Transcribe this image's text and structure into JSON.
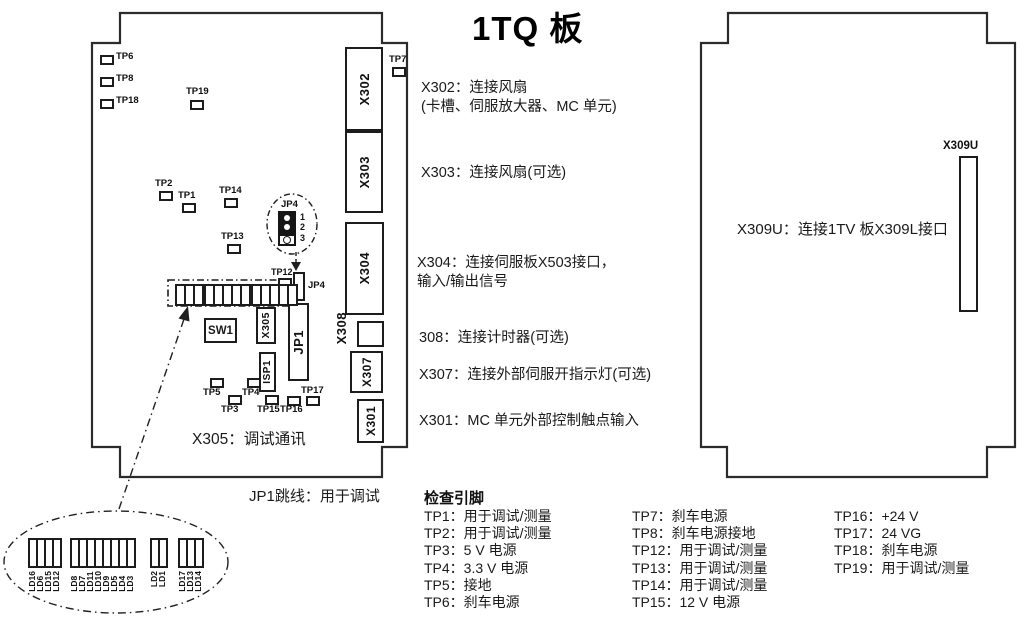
{
  "title": "1TQ 板",
  "boards": {
    "left": {
      "test_points": {
        "tp6": "TP6",
        "tp8": "TP8",
        "tp18": "TP18",
        "tp19": "TP19",
        "tp2": "TP2",
        "tp1": "TP1",
        "tp14": "TP14",
        "tp13": "TP13",
        "tp12": "TP12",
        "tp7": "TP7",
        "tp5": "TP5",
        "tp4": "TP4",
        "tp3": "TP3",
        "tp15": "TP15",
        "tp16": "TP16",
        "tp17": "TP17"
      },
      "connectors": {
        "x302": "X302",
        "x303": "X303",
        "x304": "X304",
        "x308": "X308",
        "x307": "X307",
        "x301": "X301",
        "jp1": "JP1",
        "jp4": "JP4",
        "x305": "X305",
        "isp1": "ISP1",
        "sw1": "SW1"
      },
      "note": "X305：调试通讯"
    },
    "right": {
      "connector": "X309U",
      "note": "X309U：连接1TV 板X309L接口"
    }
  },
  "jp4_detail": {
    "label": "JP4",
    "pins": [
      "1",
      "2",
      "3"
    ]
  },
  "annotations": {
    "x302_line1": "X302：连接风扇",
    "x302_line2": "(卡槽、伺服放大器、MC 单元)",
    "x303": "X303：连接风扇(可选)",
    "x304_line1": "X304：连接伺服板X503接口，",
    "x304_line2": "输入/输出信号",
    "x308": "308：连接计时器(可选)",
    "x307": "X307：连接外部伺服开指示灯(可选)",
    "x301": "X301：MC 单元外部控制触点输入",
    "jp1": "JP1跳线：用于调试"
  },
  "check_pins": {
    "header": "检查引脚",
    "col1": [
      "TP1：用于调试/测量",
      "TP2：用于调试/测量",
      "TP3：5 V 电源",
      "TP4：3.3 V 电源",
      "TP5：接地",
      "TP6：刹车电源"
    ],
    "col2": [
      "TP7：刹车电源",
      "TP8：刹车电源接地",
      "TP12：用于调试/测量",
      "TP13：用于调试/测量",
      "TP14：用于调试/测量",
      "TP15：12 V 电源"
    ],
    "col3": [
      "TP16：+24 V",
      "TP17：24 VG",
      "TP18：刹车电源",
      "TP19：用于调试/测量"
    ]
  },
  "led_detail": {
    "groups": [
      {
        "labels": [
          "LD16",
          "LD6",
          "LD15",
          "LD12"
        ]
      },
      {
        "labels": [
          "LD8",
          "LD7",
          "LD11",
          "LD10",
          "LD9",
          "LD5",
          "LD4",
          "LD3"
        ]
      },
      {
        "labels": [
          "LD2",
          "LD1"
        ]
      },
      {
        "labels": [
          "LD17",
          "LD13",
          "LD14"
        ]
      }
    ]
  }
}
